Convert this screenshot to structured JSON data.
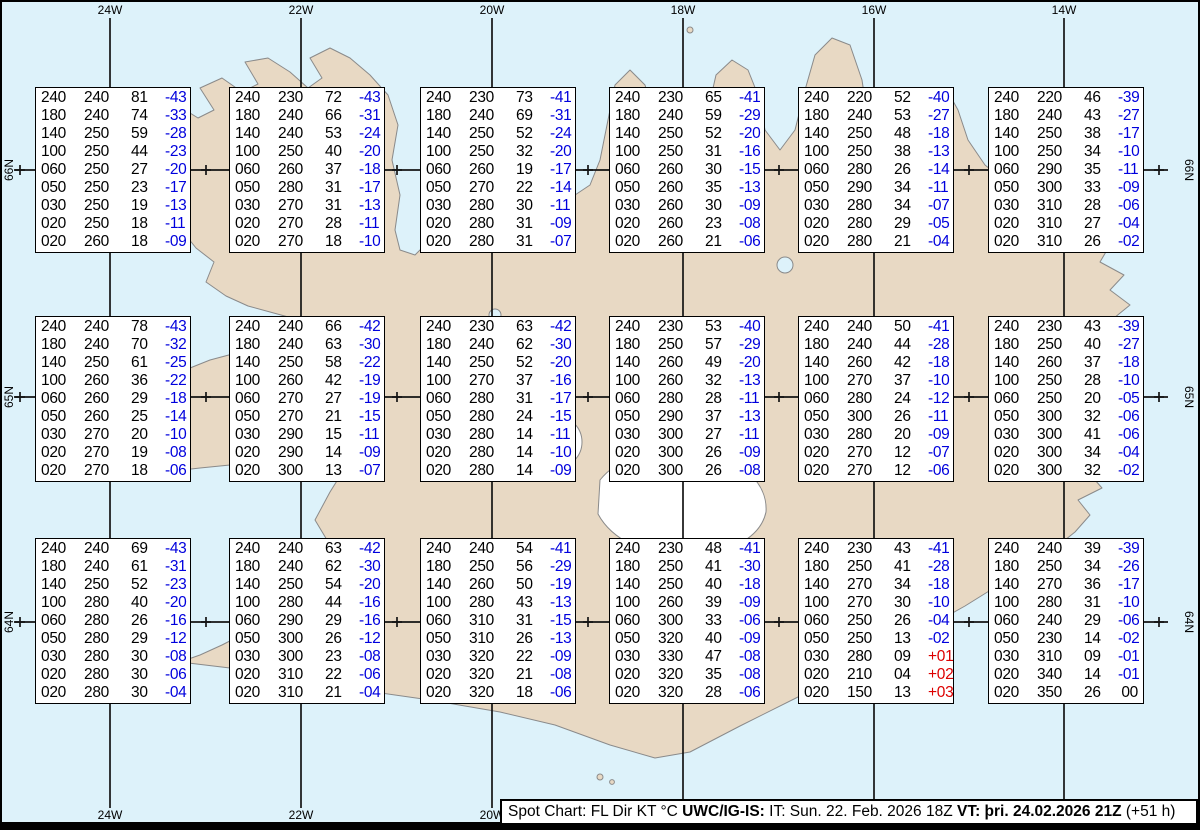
{
  "map": {
    "meridian_labels_top": [
      "24W",
      "22W",
      "20W",
      "18W",
      "16W",
      "14W"
    ],
    "meridian_labels_bottom": [
      "24W",
      "22W",
      "20W"
    ],
    "parallel_labels_left": [
      "66N",
      "65N",
      "64N"
    ],
    "parallel_labels_right": [
      "66N",
      "65N",
      "64N"
    ],
    "colors": {
      "ocean": "#ddf2fa",
      "land": "#e8d9c4",
      "coastline": "#8a8a8a",
      "glacier": "#ffffff",
      "graticule": "#141414",
      "temp_negative": "#0000dd",
      "temp_positive": "#dd0000",
      "temp_zero": "#000000"
    }
  },
  "columns": [
    "FL",
    "Dir",
    "KT",
    "°C"
  ],
  "legend_bar": {
    "segments": [
      {
        "text": "Spot Chart: FL Dir KT °C ",
        "bold": false
      },
      {
        "text": "UWC/IG-IS:",
        "bold": true
      },
      {
        "text": " IT: Sun. 22. Feb. 2026 18Z ",
        "bold": false
      },
      {
        "text": "VT: þri. 24.02.2026 21Z",
        "bold": true
      },
      {
        "text": " (+51 h)",
        "bold": false
      }
    ]
  },
  "spot_boxes": [
    {
      "id": "r1c1",
      "rows": [
        [
          "240",
          "240",
          "81",
          "-43"
        ],
        [
          "180",
          "240",
          "74",
          "-33"
        ],
        [
          "140",
          "250",
          "59",
          "-28"
        ],
        [
          "100",
          "250",
          "44",
          "-23"
        ],
        [
          "060",
          "250",
          "27",
          "-20"
        ],
        [
          "050",
          "250",
          "23",
          "-17"
        ],
        [
          "030",
          "250",
          "19",
          "-13"
        ],
        [
          "020",
          "250",
          "18",
          "-11"
        ],
        [
          "020",
          "260",
          "18",
          "-09"
        ]
      ]
    },
    {
      "id": "r1c2",
      "rows": [
        [
          "240",
          "230",
          "72",
          "-43"
        ],
        [
          "180",
          "240",
          "66",
          "-31"
        ],
        [
          "140",
          "240",
          "53",
          "-24"
        ],
        [
          "100",
          "250",
          "40",
          "-20"
        ],
        [
          "060",
          "260",
          "37",
          "-18"
        ],
        [
          "050",
          "280",
          "31",
          "-17"
        ],
        [
          "030",
          "270",
          "31",
          "-13"
        ],
        [
          "020",
          "270",
          "28",
          "-11"
        ],
        [
          "020",
          "270",
          "18",
          "-10"
        ]
      ]
    },
    {
      "id": "r1c3",
      "rows": [
        [
          "240",
          "230",
          "73",
          "-41"
        ],
        [
          "180",
          "240",
          "69",
          "-31"
        ],
        [
          "140",
          "250",
          "52",
          "-24"
        ],
        [
          "100",
          "250",
          "32",
          "-20"
        ],
        [
          "060",
          "260",
          "19",
          "-17"
        ],
        [
          "050",
          "270",
          "22",
          "-14"
        ],
        [
          "030",
          "280",
          "30",
          "-11"
        ],
        [
          "020",
          "280",
          "31",
          "-09"
        ],
        [
          "020",
          "280",
          "31",
          "-07"
        ]
      ]
    },
    {
      "id": "r1c4",
      "rows": [
        [
          "240",
          "230",
          "65",
          "-41"
        ],
        [
          "180",
          "240",
          "59",
          "-29"
        ],
        [
          "140",
          "250",
          "52",
          "-20"
        ],
        [
          "100",
          "250",
          "31",
          "-16"
        ],
        [
          "060",
          "260",
          "30",
          "-15"
        ],
        [
          "050",
          "260",
          "35",
          "-13"
        ],
        [
          "030",
          "260",
          "30",
          "-09"
        ],
        [
          "020",
          "260",
          "23",
          "-08"
        ],
        [
          "020",
          "260",
          "21",
          "-06"
        ]
      ]
    },
    {
      "id": "r1c5",
      "rows": [
        [
          "240",
          "220",
          "52",
          "-40"
        ],
        [
          "180",
          "240",
          "53",
          "-27"
        ],
        [
          "140",
          "250",
          "48",
          "-18"
        ],
        [
          "100",
          "250",
          "38",
          "-13"
        ],
        [
          "060",
          "280",
          "26",
          "-14"
        ],
        [
          "050",
          "290",
          "34",
          "-11"
        ],
        [
          "030",
          "280",
          "34",
          "-07"
        ],
        [
          "020",
          "280",
          "29",
          "-05"
        ],
        [
          "020",
          "280",
          "21",
          "-04"
        ]
      ]
    },
    {
      "id": "r1c6",
      "rows": [
        [
          "240",
          "220",
          "46",
          "-39"
        ],
        [
          "180",
          "240",
          "43",
          "-27"
        ],
        [
          "140",
          "250",
          "38",
          "-17"
        ],
        [
          "100",
          "250",
          "34",
          "-10"
        ],
        [
          "060",
          "290",
          "35",
          "-11"
        ],
        [
          "050",
          "300",
          "33",
          "-09"
        ],
        [
          "030",
          "310",
          "28",
          "-06"
        ],
        [
          "020",
          "310",
          "27",
          "-04"
        ],
        [
          "020",
          "310",
          "26",
          "-02"
        ]
      ]
    },
    {
      "id": "r2c1",
      "rows": [
        [
          "240",
          "240",
          "78",
          "-43"
        ],
        [
          "180",
          "240",
          "70",
          "-32"
        ],
        [
          "140",
          "250",
          "61",
          "-25"
        ],
        [
          "100",
          "260",
          "36",
          "-22"
        ],
        [
          "060",
          "260",
          "29",
          "-18"
        ],
        [
          "050",
          "260",
          "25",
          "-14"
        ],
        [
          "030",
          "270",
          "20",
          "-10"
        ],
        [
          "020",
          "270",
          "19",
          "-08"
        ],
        [
          "020",
          "270",
          "18",
          "-06"
        ]
      ]
    },
    {
      "id": "r2c2",
      "rows": [
        [
          "240",
          "240",
          "66",
          "-42"
        ],
        [
          "180",
          "240",
          "63",
          "-30"
        ],
        [
          "140",
          "250",
          "58",
          "-22"
        ],
        [
          "100",
          "260",
          "42",
          "-19"
        ],
        [
          "060",
          "270",
          "27",
          "-19"
        ],
        [
          "050",
          "270",
          "21",
          "-15"
        ],
        [
          "030",
          "290",
          "15",
          "-11"
        ],
        [
          "020",
          "290",
          "14",
          "-09"
        ],
        [
          "020",
          "300",
          "13",
          "-07"
        ]
      ]
    },
    {
      "id": "r2c3",
      "rows": [
        [
          "240",
          "230",
          "63",
          "-42"
        ],
        [
          "180",
          "240",
          "62",
          "-30"
        ],
        [
          "140",
          "250",
          "52",
          "-20"
        ],
        [
          "100",
          "270",
          "37",
          "-16"
        ],
        [
          "060",
          "280",
          "31",
          "-17"
        ],
        [
          "050",
          "280",
          "24",
          "-15"
        ],
        [
          "030",
          "280",
          "14",
          "-11"
        ],
        [
          "020",
          "280",
          "14",
          "-10"
        ],
        [
          "020",
          "280",
          "14",
          "-09"
        ]
      ]
    },
    {
      "id": "r2c4",
      "rows": [
        [
          "240",
          "230",
          "53",
          "-40"
        ],
        [
          "180",
          "250",
          "57",
          "-29"
        ],
        [
          "140",
          "260",
          "49",
          "-20"
        ],
        [
          "100",
          "260",
          "32",
          "-13"
        ],
        [
          "060",
          "280",
          "28",
          "-11"
        ],
        [
          "050",
          "290",
          "37",
          "-13"
        ],
        [
          "030",
          "300",
          "27",
          "-11"
        ],
        [
          "020",
          "300",
          "26",
          "-09"
        ],
        [
          "020",
          "300",
          "26",
          "-08"
        ]
      ]
    },
    {
      "id": "r2c5",
      "rows": [
        [
          "240",
          "240",
          "50",
          "-41"
        ],
        [
          "180",
          "240",
          "44",
          "-28"
        ],
        [
          "140",
          "260",
          "42",
          "-18"
        ],
        [
          "100",
          "270",
          "37",
          "-10"
        ],
        [
          "060",
          "280",
          "24",
          "-12"
        ],
        [
          "050",
          "300",
          "26",
          "-11"
        ],
        [
          "030",
          "280",
          "20",
          "-09"
        ],
        [
          "020",
          "270",
          "12",
          "-07"
        ],
        [
          "020",
          "270",
          "12",
          "-06"
        ]
      ]
    },
    {
      "id": "r2c6",
      "rows": [
        [
          "240",
          "230",
          "43",
          "-39"
        ],
        [
          "180",
          "250",
          "40",
          "-27"
        ],
        [
          "140",
          "260",
          "37",
          "-18"
        ],
        [
          "100",
          "250",
          "28",
          "-10"
        ],
        [
          "060",
          "250",
          "20",
          "-05"
        ],
        [
          "050",
          "300",
          "32",
          "-06"
        ],
        [
          "030",
          "300",
          "41",
          "-06"
        ],
        [
          "020",
          "300",
          "34",
          "-04"
        ],
        [
          "020",
          "300",
          "32",
          "-02"
        ]
      ]
    },
    {
      "id": "r3c1",
      "rows": [
        [
          "240",
          "240",
          "69",
          "-43"
        ],
        [
          "180",
          "240",
          "61",
          "-31"
        ],
        [
          "140",
          "250",
          "52",
          "-23"
        ],
        [
          "100",
          "280",
          "40",
          "-20"
        ],
        [
          "060",
          "280",
          "26",
          "-16"
        ],
        [
          "050",
          "280",
          "29",
          "-12"
        ],
        [
          "030",
          "280",
          "30",
          "-08"
        ],
        [
          "020",
          "280",
          "30",
          "-06"
        ],
        [
          "020",
          "280",
          "30",
          "-04"
        ]
      ]
    },
    {
      "id": "r3c2",
      "rows": [
        [
          "240",
          "240",
          "63",
          "-42"
        ],
        [
          "180",
          "240",
          "62",
          "-30"
        ],
        [
          "140",
          "250",
          "54",
          "-20"
        ],
        [
          "100",
          "280",
          "44",
          "-16"
        ],
        [
          "060",
          "290",
          "29",
          "-16"
        ],
        [
          "050",
          "300",
          "26",
          "-12"
        ],
        [
          "030",
          "300",
          "23",
          "-08"
        ],
        [
          "020",
          "310",
          "22",
          "-06"
        ],
        [
          "020",
          "310",
          "21",
          "-04"
        ]
      ]
    },
    {
      "id": "r3c3",
      "rows": [
        [
          "240",
          "240",
          "54",
          "-41"
        ],
        [
          "180",
          "250",
          "56",
          "-29"
        ],
        [
          "140",
          "260",
          "50",
          "-19"
        ],
        [
          "100",
          "280",
          "43",
          "-13"
        ],
        [
          "060",
          "310",
          "31",
          "-15"
        ],
        [
          "050",
          "310",
          "26",
          "-13"
        ],
        [
          "030",
          "320",
          "22",
          "-09"
        ],
        [
          "020",
          "320",
          "21",
          "-08"
        ],
        [
          "020",
          "320",
          "18",
          "-06"
        ]
      ]
    },
    {
      "id": "r3c4",
      "rows": [
        [
          "240",
          "230",
          "48",
          "-41"
        ],
        [
          "180",
          "250",
          "41",
          "-30"
        ],
        [
          "140",
          "250",
          "40",
          "-18"
        ],
        [
          "100",
          "260",
          "39",
          "-09"
        ],
        [
          "060",
          "300",
          "33",
          "-06"
        ],
        [
          "050",
          "320",
          "40",
          "-09"
        ],
        [
          "030",
          "330",
          "47",
          "-08"
        ],
        [
          "020",
          "320",
          "35",
          "-08"
        ],
        [
          "020",
          "320",
          "28",
          "-06"
        ]
      ]
    },
    {
      "id": "r3c5",
      "rows": [
        [
          "240",
          "230",
          "43",
          "-41"
        ],
        [
          "180",
          "250",
          "41",
          "-28"
        ],
        [
          "140",
          "270",
          "34",
          "-18"
        ],
        [
          "100",
          "270",
          "30",
          "-10"
        ],
        [
          "060",
          "250",
          "26",
          "-04"
        ],
        [
          "050",
          "250",
          "13",
          "-02"
        ],
        [
          "030",
          "280",
          "09",
          "+01"
        ],
        [
          "020",
          "210",
          "04",
          "+02"
        ],
        [
          "020",
          "150",
          "13",
          "+03"
        ]
      ]
    },
    {
      "id": "r3c6",
      "rows": [
        [
          "240",
          "240",
          "39",
          "-39"
        ],
        [
          "180",
          "250",
          "34",
          "-26"
        ],
        [
          "140",
          "270",
          "36",
          "-17"
        ],
        [
          "100",
          "280",
          "31",
          "-10"
        ],
        [
          "060",
          "240",
          "29",
          "-06"
        ],
        [
          "050",
          "230",
          "14",
          "-02"
        ],
        [
          "030",
          "310",
          "09",
          "-01"
        ],
        [
          "020",
          "340",
          "14",
          "-01"
        ],
        [
          "020",
          "350",
          "26",
          "00"
        ]
      ]
    }
  ]
}
